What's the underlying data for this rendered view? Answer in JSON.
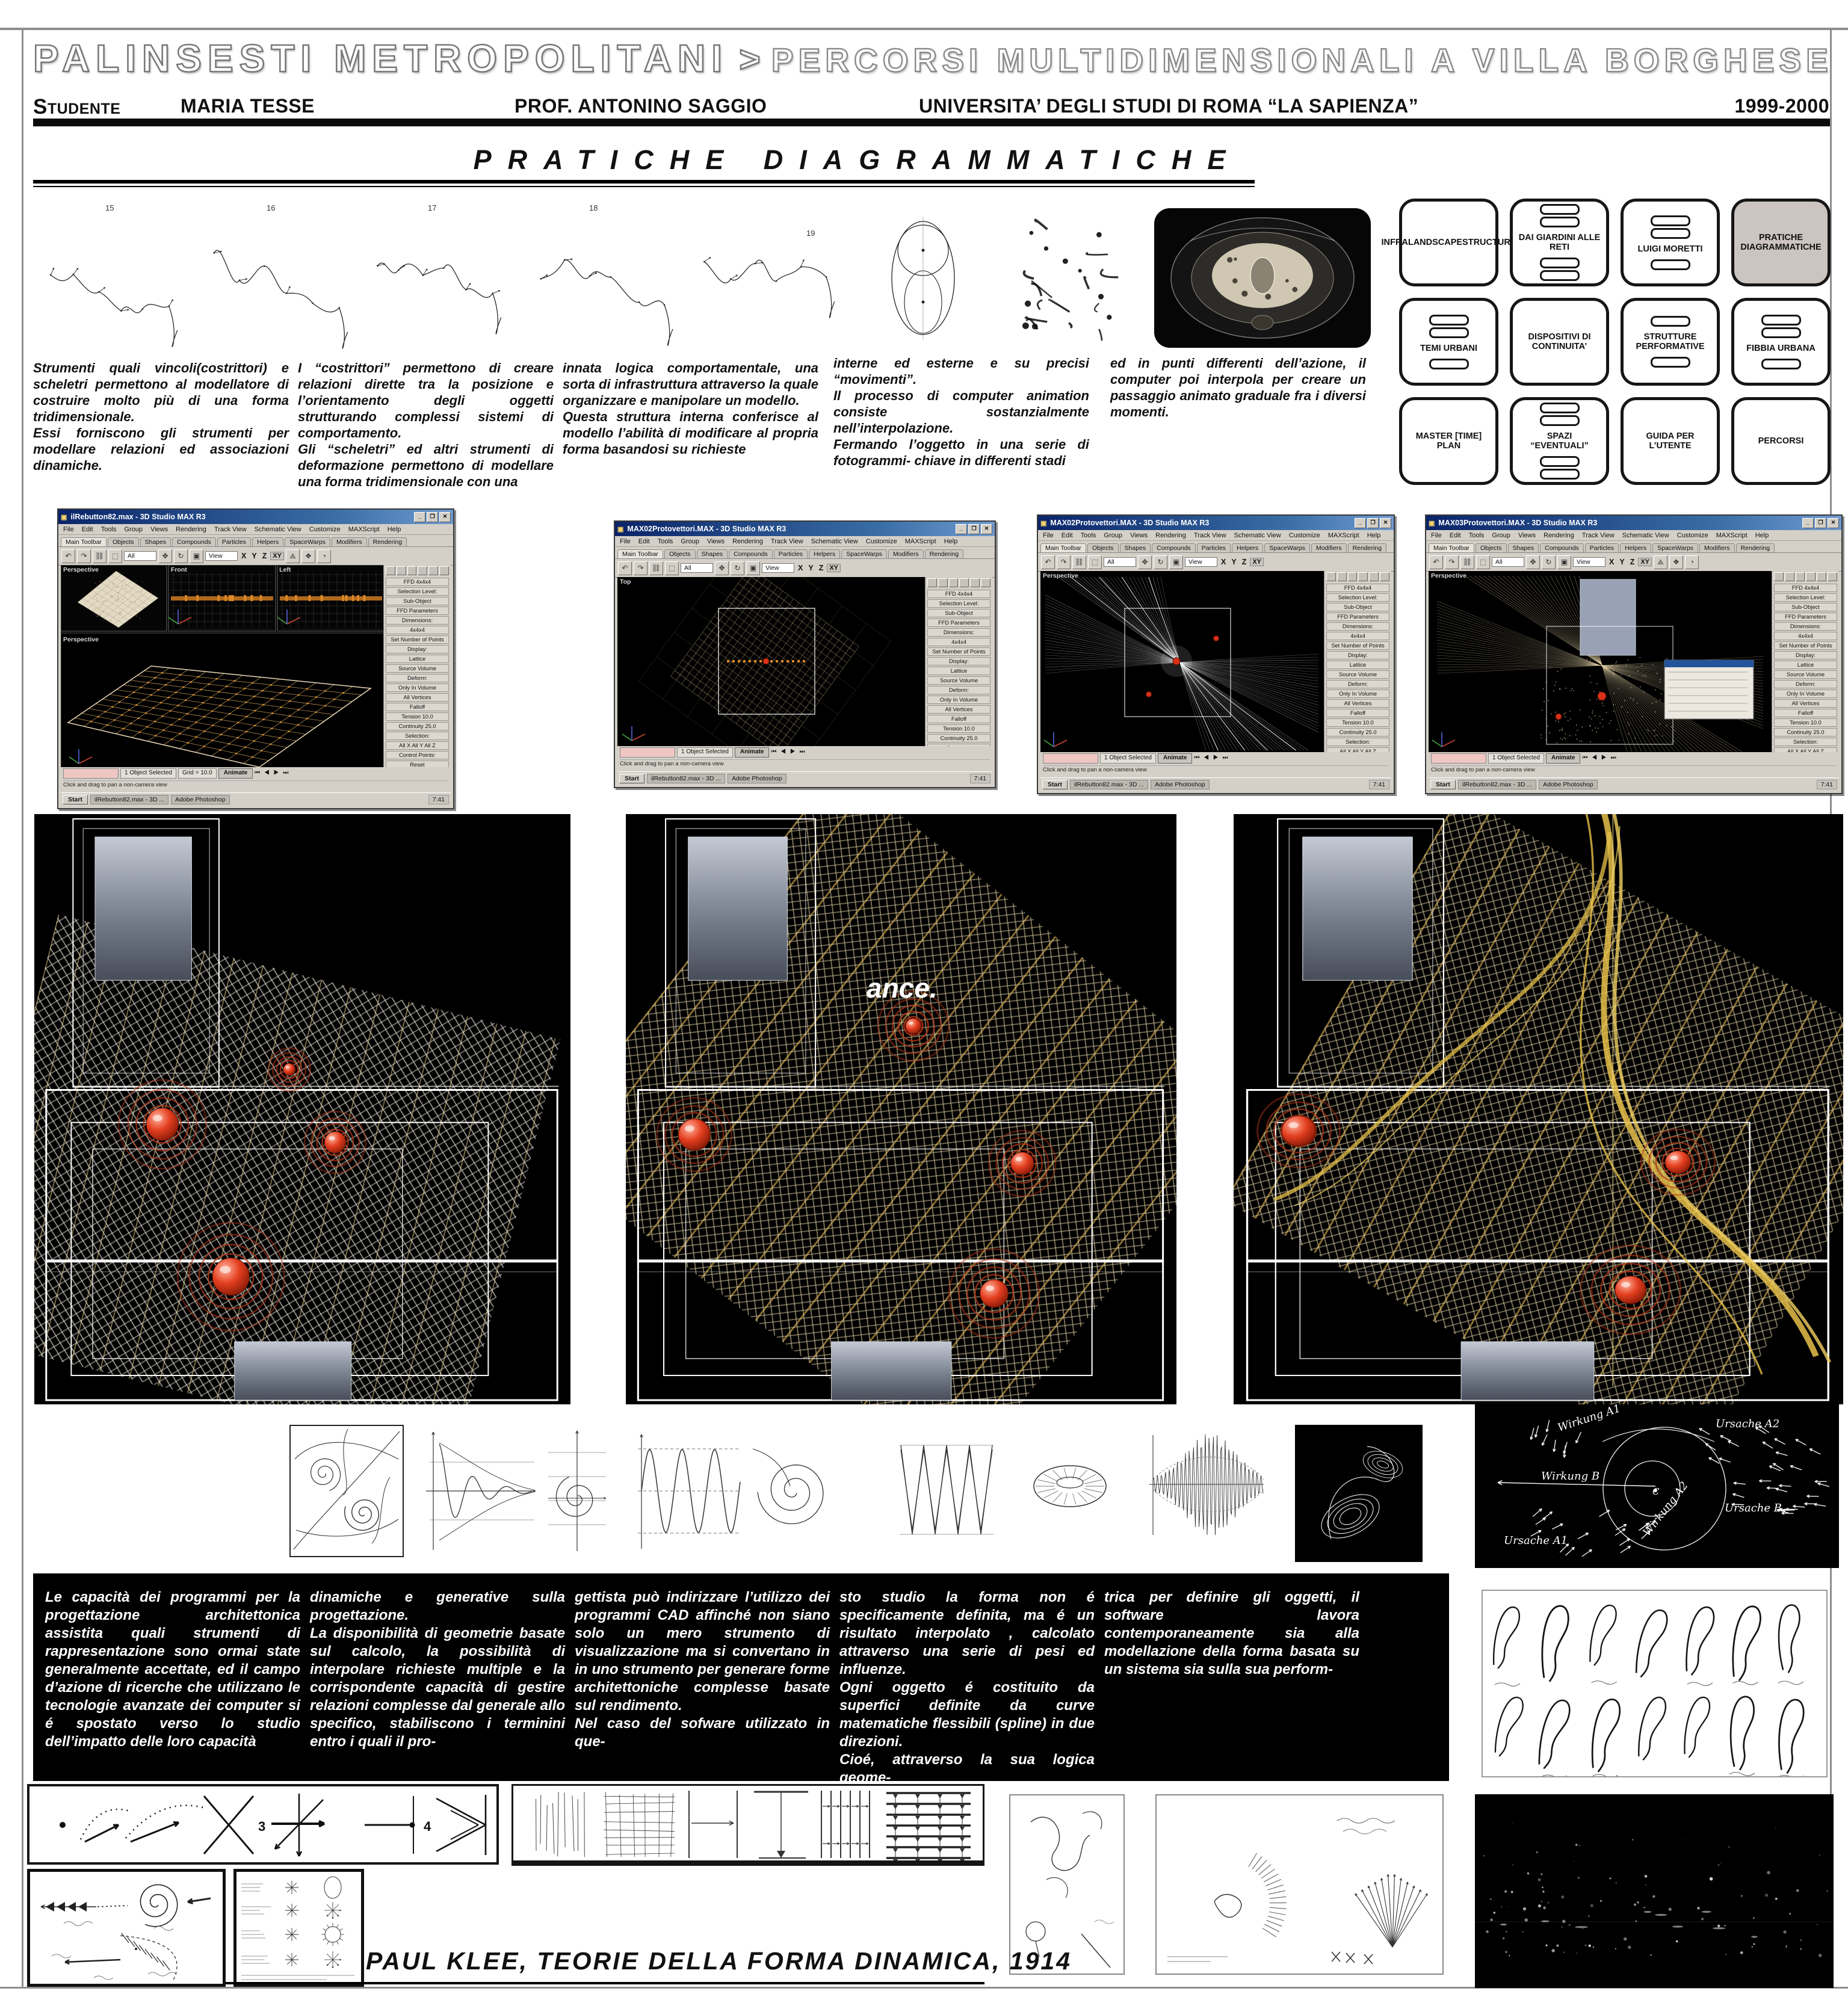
{
  "header": {
    "title_main": "PALINSESTI METROPOLITANI",
    "title_sep": ">",
    "title_sub": "PERCORSI MULTIDIMENSIONALI A VILLA BORGHESE",
    "student_label": "Studente",
    "student_name": "MARIA TESSE",
    "professor": "PROF. ANTONINO SAGGIO",
    "university": "UNIVERSITA’ DEGLI STUDI DI ROMA “LA SAPIENZA”",
    "years": "1999-2000"
  },
  "section_title": "PRATICHE DIAGRAMMATICHE",
  "sketch_numbers": [
    "15",
    "16",
    "17",
    "18",
    "19"
  ],
  "nav": {
    "buttons": [
      {
        "label": "INFRALANDSCAPESTRUCTURE"
      },
      {
        "label": "DAI GIARDINI ALLE RETI"
      },
      {
        "label": "LUIGI MORETTI"
      },
      {
        "label": "PRATICHE DIAGRAMMATICHE"
      },
      {
        "label": "TEMI URBANI"
      },
      {
        "label": "DISPOSITIVI DI CONTINUITA’"
      },
      {
        "label": "STRUTTURE PERFORMATIVE"
      },
      {
        "label": "FIBBIA URBANA"
      },
      {
        "label": "MASTER [TIME] PLAN"
      },
      {
        "label": "SPAZI “EVENTUALI”"
      },
      {
        "label": "GUIDA PER L’UTENTE"
      },
      {
        "label": "PERCORSI"
      }
    ]
  },
  "intro_columns": [
    "Strumenti quali vincoli(costrittori) e scheletri permettono al modellatore di costruire molto più di una forma tridimensionale.\nEssi forniscono gli strumenti per modellare relazioni ed associazioni dinamiche.",
    "I “costrittori” permettono di creare relazioni dirette tra la posizione e l’orientamento degli oggetti strutturando complessi sistemi di comportamento.\nGli “scheletri” ed altri strumenti di deformazione permettono di modellare una forma tridimensionale con una",
    "innata logica comportamentale, una sorta di infrastruttura attraverso la quale organizzare e manipolare un modello.\nQuesta struttura interna conferisce al modello l’abilità di modificare al propria forma basandosi su richieste",
    "interne ed esterne e su precisi “movimenti”.\nIl processo di computer animation consiste sostanzialmente nell’interpolazione.\nFermando l’oggetto in una serie di fotogrammi- chiave in differenti stadi",
    "ed in punti differenti dell’azione, il computer poi interpola per creare un passaggio animato graduale fra i diversi momenti."
  ],
  "max": {
    "windows": [
      {
        "title": "ilRebutton82.max - 3D Studio MAX R3"
      },
      {
        "title": "MAX02Protovettori.MAX - 3D Studio MAX R3"
      },
      {
        "title": "MAX02Protovettori.MAX - 3D Studio MAX R3"
      },
      {
        "title": "MAX03Protovettori.MAX - 3D Studio MAX R3"
      }
    ],
    "common": {
      "menu": [
        "File",
        "Edit",
        "Tools",
        "Group",
        "Views",
        "Rendering",
        "Track View",
        "Schematic View",
        "Customize",
        "MAXScript",
        "Help"
      ],
      "tabs": [
        "Main Toolbar",
        "Objects",
        "Shapes",
        "Compounds",
        "Particles",
        "Helpers",
        "SpaceWarps",
        "Modifiers",
        "Rendering"
      ],
      "filter": "All",
      "view": "View",
      "axes": [
        "X",
        "Y",
        "Z",
        "XY"
      ],
      "viewports": {
        "persp": "Perspective",
        "front": "Front",
        "left": "Left",
        "top": "Top"
      },
      "panel_rows": [
        "FFD 4x4x4",
        "Selection Level:",
        "Sub-Object",
        "FFD Parameters",
        "Dimensions:",
        "4x4x4",
        "Set Number of Points",
        "Display:",
        "Lattice",
        "Source Volume",
        "Deform:",
        "Only In Volume",
        "All Vertices",
        "Falloff",
        "Tension  10.0",
        "Continuity  25.0",
        "Selection:",
        "All X   All Y   All Z",
        "Control Points:",
        "Reset",
        "Animate All"
      ],
      "status": {
        "selected": "1 Object Selected",
        "grid": "Grid = 10.0",
        "animate": "Animate",
        "prompt": "Click and drag to pan a non-camera view"
      },
      "taskbar": {
        "start": "Start",
        "tasks": [
          "ilRebutton82.max - 3D ...",
          "Adobe Photoshop"
        ],
        "time": "7:41"
      }
    }
  },
  "panels": {
    "ance": "ance."
  },
  "klee_diagram": {
    "labels": {
      "wirkung_a1": "Wirkung A1",
      "ursache_a2": "Ursache A2",
      "wirkung_b": "Wirkung B",
      "ursache_b": "Ursache B",
      "ursache_a1": "Ursache A1",
      "wirkung_a2": "Wirkung A2",
      "c": "C"
    }
  },
  "bottom_columns": [
    "Le capacità dei programmi per la progettazione architettonica assistita quali strumenti di rappresentazione sono ormai state generalmente accettate, ed il campo d’azione  di ricerche che utilizzano le tecnologie avanzate dei computer si é spostato verso lo studio dell’impatto delle loro capacità",
    "dinamiche e generative sulla progettazione.\nLa disponibilità di geometrie basate sul calcolo, la possibilità di interpolare richieste multiple e la corrispondente capacità di gestire relazioni complesse dal generale allo specifico, stabiliscono i terminini entro i quali il pro-",
    "gettista può indirizzare l’utilizzo dei programmi CAD affinché non siano solo un mero strumento di visualizzazione ma si convertano in in uno strumento per generare forme architettoniche complesse basate sul rendimento.\nNel caso del sofware utilizzato in que-",
    "sto studio la forma non é specificamente definita, ma é un risultato interpolato , calcolato attraverso una serie di pesi ed influenze.\nOgni oggetto é costituito  da superfici definite da curve matematiche flessibili (spline) in due direzioni.\nCioé, attraverso la sua logica geome-",
    "trica per definire gli oggetti, il software lavora contemporaneamente sia alla  modellazione della forma basata su un sistema sia sulla sua perform-"
  ],
  "arrows_box": {
    "n3": "3",
    "n4": "4"
  },
  "caption": "PAUL KLEE, TEORIE DELLA  FORMA DINAMICA, 1914"
}
